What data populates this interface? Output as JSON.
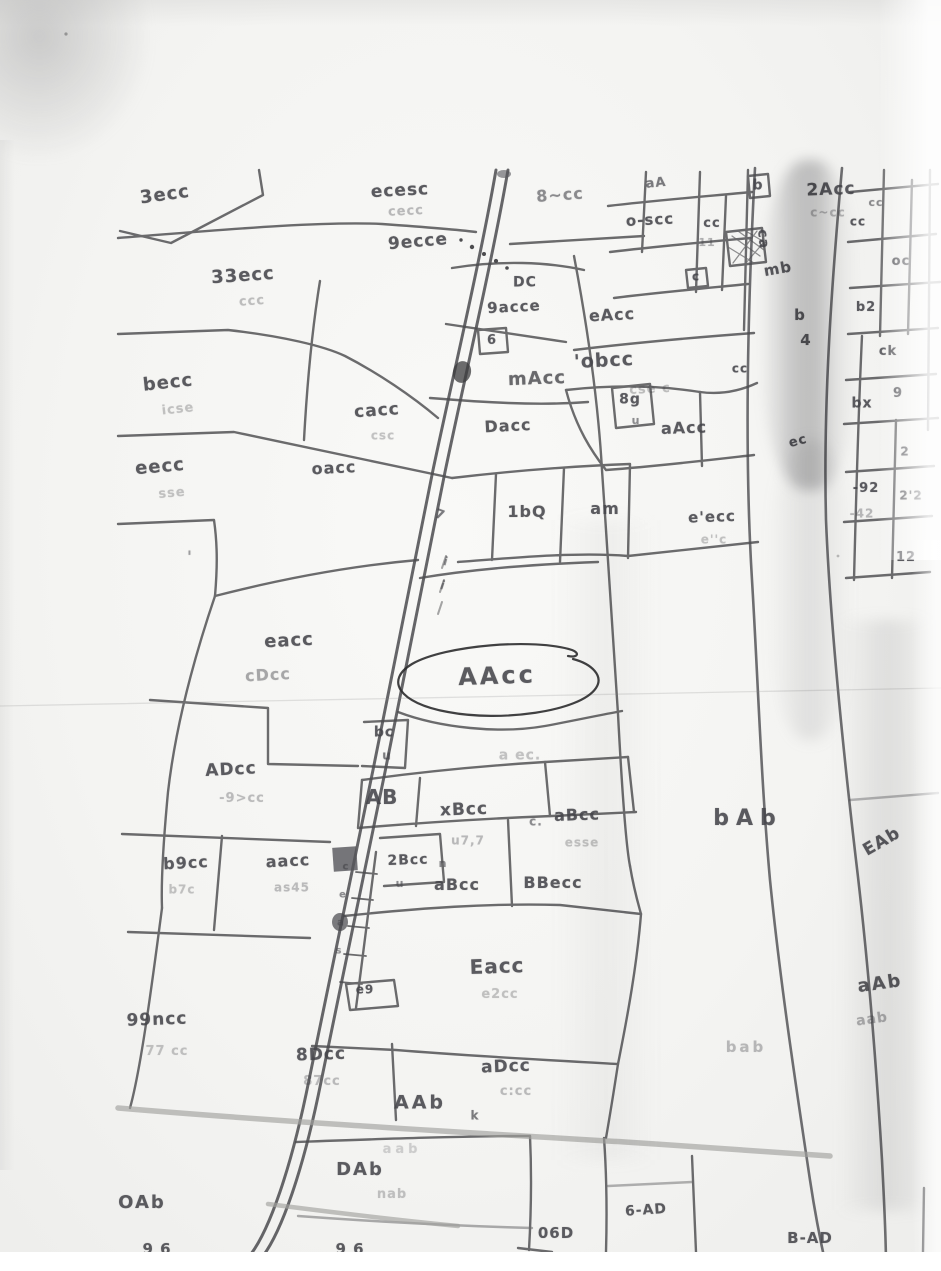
{
  "page": {
    "colors": {
      "paper": "#f6f6f4",
      "ink": "#45454a",
      "pencil_road": "#a0a09c",
      "boundary": "#4c4c4f"
    }
  },
  "map": {
    "circled_plot": {
      "label": "AAcc"
    },
    "labels": [
      {
        "t": "3ecc",
        "x": 165,
        "y": 196,
        "s": 18,
        "r": -8
      },
      {
        "t": "33ecc",
        "x": 243,
        "y": 277,
        "s": 18,
        "r": -4
      },
      {
        "t": "ccc",
        "x": 252,
        "y": 302,
        "s": 13,
        "r": -4,
        "o": 0.32
      },
      {
        "t": "becc",
        "x": 168,
        "y": 384,
        "s": 18,
        "r": -6
      },
      {
        "t": "icse",
        "x": 178,
        "y": 410,
        "s": 13,
        "r": -6,
        "o": 0.3
      },
      {
        "t": "eecc",
        "x": 160,
        "y": 468,
        "s": 18,
        "r": -5
      },
      {
        "t": "sse",
        "x": 172,
        "y": 494,
        "s": 13,
        "r": -5,
        "o": 0.3
      },
      {
        "t": "ecesc",
        "x": 400,
        "y": 192,
        "s": 17,
        "r": -3
      },
      {
        "t": "cecc",
        "x": 406,
        "y": 212,
        "s": 13,
        "r": -3,
        "o": 0.35
      },
      {
        "t": "9ecce",
        "x": 418,
        "y": 243,
        "s": 17,
        "r": -5
      },
      {
        "t": "8~cc",
        "x": 560,
        "y": 196,
        "s": 16,
        "r": -4,
        "o": 0.6
      },
      {
        "t": "aA",
        "x": 656,
        "y": 184,
        "s": 13,
        "r": -6,
        "o": 0.7
      },
      {
        "t": "b",
        "x": 758,
        "y": 186,
        "s": 14
      },
      {
        "t": "2Acc",
        "x": 831,
        "y": 191,
        "s": 17,
        "r": -2
      },
      {
        "t": "c~cc",
        "x": 828,
        "y": 213,
        "s": 12,
        "o": 0.35
      },
      {
        "t": "o-scc",
        "x": 650,
        "y": 221,
        "s": 15,
        "r": -3
      },
      {
        "t": "cc",
        "x": 712,
        "y": 224,
        "s": 13
      },
      {
        "t": "11",
        "x": 707,
        "y": 243,
        "s": 11,
        "o": 0.4
      },
      {
        "t": "ca",
        "x": 763,
        "y": 240,
        "s": 14,
        "r": 85
      },
      {
        "t": "mb",
        "x": 778,
        "y": 270,
        "s": 15,
        "r": -10,
        "w": "b"
      },
      {
        "t": "c",
        "x": 696,
        "y": 277,
        "s": 12
      },
      {
        "t": "cc",
        "x": 858,
        "y": 222,
        "s": 12
      },
      {
        "t": "cc",
        "x": 876,
        "y": 203,
        "s": 11,
        "o": 0.6
      },
      {
        "t": "oc",
        "x": 901,
        "y": 262,
        "s": 13
      },
      {
        "t": "b2",
        "x": 866,
        "y": 308,
        "s": 13
      },
      {
        "t": "b",
        "x": 800,
        "y": 316,
        "s": 15,
        "w": "b"
      },
      {
        "t": "4",
        "x": 806,
        "y": 341,
        "s": 15,
        "w": "b"
      },
      {
        "t": "ck",
        "x": 888,
        "y": 352,
        "s": 13
      },
      {
        "t": "bx",
        "x": 862,
        "y": 404,
        "s": 14
      },
      {
        "t": "9",
        "x": 898,
        "y": 394,
        "s": 13
      },
      {
        "t": "2",
        "x": 905,
        "y": 452,
        "s": 12
      },
      {
        "t": "-92",
        "x": 866,
        "y": 489,
        "s": 13
      },
      {
        "t": "-42",
        "x": 862,
        "y": 514,
        "s": 12,
        "o": 0.35
      },
      {
        "t": "2'2",
        "x": 911,
        "y": 496,
        "s": 12
      },
      {
        "t": "12",
        "x": 906,
        "y": 558,
        "s": 13
      },
      {
        "t": "eAcc",
        "x": 612,
        "y": 316,
        "s": 16,
        "r": -3
      },
      {
        "t": "'obcc",
        "x": 604,
        "y": 362,
        "s": 19,
        "r": -3,
        "w": "b"
      },
      {
        "t": "cse c",
        "x": 650,
        "y": 390,
        "s": 13,
        "r": -3,
        "o": 0.32
      },
      {
        "t": "8g",
        "x": 630,
        "y": 400,
        "s": 14
      },
      {
        "t": "u",
        "x": 636,
        "y": 421,
        "s": 11,
        "o": 0.6
      },
      {
        "t": "aAcc",
        "x": 684,
        "y": 429,
        "s": 16,
        "r": -2
      },
      {
        "t": "cc",
        "x": 740,
        "y": 369,
        "s": 12
      },
      {
        "t": "ec",
        "x": 798,
        "y": 442,
        "s": 13,
        "r": -15
      },
      {
        "t": "DC",
        "x": 525,
        "y": 283,
        "s": 14
      },
      {
        "t": "9acce",
        "x": 514,
        "y": 308,
        "s": 15,
        "r": -3
      },
      {
        "t": "6",
        "x": 492,
        "y": 341,
        "s": 13
      },
      {
        "t": "mAcc",
        "x": 537,
        "y": 380,
        "s": 18,
        "w": "b",
        "r": -2,
        "o": 0.8
      },
      {
        "t": "Dacc",
        "x": 508,
        "y": 427,
        "s": 16,
        "r": -3
      },
      {
        "t": "cacc",
        "x": 377,
        "y": 412,
        "s": 17,
        "r": -4
      },
      {
        "t": "csc",
        "x": 383,
        "y": 436,
        "s": 12,
        "o": 0.3
      },
      {
        "t": "oacc",
        "x": 334,
        "y": 469,
        "s": 16,
        "r": -3
      },
      {
        "t": "1bQ",
        "x": 527,
        "y": 513,
        "s": 16
      },
      {
        "t": "am",
        "x": 605,
        "y": 510,
        "s": 16
      },
      {
        "t": "e'ecc",
        "x": 712,
        "y": 518,
        "s": 15,
        "r": -2
      },
      {
        "t": "e''c",
        "x": 714,
        "y": 540,
        "s": 12,
        "o": 0.3
      },
      {
        "t": "7",
        "x": 440,
        "y": 516,
        "s": 13,
        "o": 0.7,
        "r": 20
      },
      {
        "t": "eacc",
        "x": 289,
        "y": 642,
        "s": 18,
        "r": -3
      },
      {
        "t": "cDcc",
        "x": 268,
        "y": 676,
        "s": 16,
        "r": -3,
        "o": 0.45
      },
      {
        "t": "AAcc",
        "x": 497,
        "y": 677,
        "s": 24,
        "ls": 3,
        "r": -2
      },
      {
        "t": "a ec.",
        "x": 520,
        "y": 756,
        "s": 14,
        "o": 0.3
      },
      {
        "t": "bc",
        "x": 384,
        "y": 733,
        "s": 14
      },
      {
        "t": "u",
        "x": 387,
        "y": 756,
        "s": 12,
        "o": 0.7
      },
      {
        "t": "ADcc",
        "x": 231,
        "y": 771,
        "s": 17,
        "r": -3
      },
      {
        "t": "-9>cc",
        "x": 242,
        "y": 799,
        "s": 13,
        "o": 0.33
      },
      {
        "t": "AB",
        "x": 382,
        "y": 798,
        "s": 20,
        "w": "b"
      },
      {
        "t": "xBcc",
        "x": 464,
        "y": 811,
        "s": 17,
        "r": -2,
        "w": "b"
      },
      {
        "t": "c.",
        "x": 536,
        "y": 822,
        "s": 12,
        "o": 0.6
      },
      {
        "t": "u7,7",
        "x": 468,
        "y": 841,
        "s": 12,
        "o": 0.35
      },
      {
        "t": "aBcc",
        "x": 577,
        "y": 816,
        "s": 16,
        "r": -2
      },
      {
        "t": "esse",
        "x": 582,
        "y": 843,
        "s": 12,
        "o": 0.3
      },
      {
        "t": "2Bcc",
        "x": 408,
        "y": 861,
        "s": 14,
        "r": -2
      },
      {
        "t": "u",
        "x": 400,
        "y": 884,
        "s": 11,
        "o": 0.6
      },
      {
        "t": "n",
        "x": 443,
        "y": 864,
        "s": 11,
        "o": 0.6
      },
      {
        "t": "aBcc",
        "x": 457,
        "y": 886,
        "s": 16,
        "w": "b"
      },
      {
        "t": "BBecc",
        "x": 553,
        "y": 884,
        "s": 16,
        "w": "b"
      },
      {
        "t": "b9cc",
        "x": 186,
        "y": 864,
        "s": 16,
        "r": -3
      },
      {
        "t": "b7c",
        "x": 182,
        "y": 890,
        "s": 12,
        "o": 0.3
      },
      {
        "t": "aacc",
        "x": 288,
        "y": 862,
        "s": 16,
        "r": -3
      },
      {
        "t": "as45",
        "x": 292,
        "y": 888,
        "s": 12,
        "o": 0.33
      },
      {
        "t": "bAb",
        "x": 748,
        "y": 820,
        "s": 22,
        "ls": 7
      },
      {
        "t": "EAb",
        "x": 882,
        "y": 843,
        "s": 17,
        "r": -30
      },
      {
        "t": "Eacc",
        "x": 497,
        "y": 967,
        "s": 20,
        "w": "b",
        "r": -2
      },
      {
        "t": "e2cc",
        "x": 500,
        "y": 995,
        "s": 13,
        "o": 0.3
      },
      {
        "t": "e9",
        "x": 365,
        "y": 990,
        "s": 12
      },
      {
        "t": "99ncc",
        "x": 157,
        "y": 1021,
        "s": 17,
        "r": -2
      },
      {
        "t": "77 cc",
        "x": 167,
        "y": 1052,
        "s": 13,
        "o": 0.3
      },
      {
        "t": "8Dcc",
        "x": 321,
        "y": 1056,
        "s": 17,
        "r": -2,
        "w": "b"
      },
      {
        "t": "87cc",
        "x": 322,
        "y": 1082,
        "s": 13,
        "o": 0.33
      },
      {
        "t": "aDcc",
        "x": 506,
        "y": 1068,
        "s": 17,
        "r": -2,
        "w": "b"
      },
      {
        "t": "c:cc",
        "x": 516,
        "y": 1092,
        "s": 13,
        "o": 0.33
      },
      {
        "t": "AAb",
        "x": 420,
        "y": 1104,
        "s": 19,
        "ls": 3
      },
      {
        "t": "k",
        "x": 475,
        "y": 1116,
        "s": 12,
        "o": 0.7
      },
      {
        "t": "aab",
        "x": 402,
        "y": 1150,
        "s": 13,
        "o": 0.22,
        "ls": 4
      },
      {
        "t": "DAb",
        "x": 360,
        "y": 1171,
        "s": 18,
        "ls": 2
      },
      {
        "t": "nab",
        "x": 392,
        "y": 1195,
        "s": 13,
        "o": 0.3
      },
      {
        "t": "OAb",
        "x": 142,
        "y": 1204,
        "s": 18,
        "ls": 2
      },
      {
        "t": "aAb",
        "x": 880,
        "y": 985,
        "s": 18,
        "r": -8,
        "ls": 2
      },
      {
        "t": "aab",
        "x": 872,
        "y": 1020,
        "s": 14,
        "o": 0.4,
        "r": -8
      },
      {
        "t": "bab",
        "x": 746,
        "y": 1048,
        "s": 15,
        "o": 0.35,
        "ls": 3
      },
      {
        "t": "06D",
        "x": 556,
        "y": 1234,
        "s": 15
      },
      {
        "t": "6-AD",
        "x": 646,
        "y": 1211,
        "s": 14,
        "r": -4
      },
      {
        "t": "B-AD",
        "x": 810,
        "y": 1239,
        "s": 15
      },
      {
        "t": "9 6",
        "x": 157,
        "y": 1250,
        "s": 15
      },
      {
        "t": "9 6",
        "x": 350,
        "y": 1250,
        "s": 15
      },
      {
        "t": "c",
        "x": 346,
        "y": 868,
        "s": 10,
        "o": 0.65
      },
      {
        "t": "e",
        "x": 343,
        "y": 896,
        "s": 10,
        "o": 0.6
      },
      {
        "t": "a",
        "x": 341,
        "y": 924,
        "s": 10,
        "o": 0.6
      },
      {
        "t": "s",
        "x": 339,
        "y": 952,
        "s": 10,
        "o": 0.55
      },
      {
        "t": "i",
        "x": 446,
        "y": 562,
        "s": 12,
        "o": 0.6,
        "r": 15
      },
      {
        "t": "i",
        "x": 443,
        "y": 586,
        "s": 12,
        "o": 0.6,
        "r": 18
      },
      {
        "t": "'",
        "x": 190,
        "y": 558,
        "s": 16,
        "o": 0.5
      }
    ]
  }
}
